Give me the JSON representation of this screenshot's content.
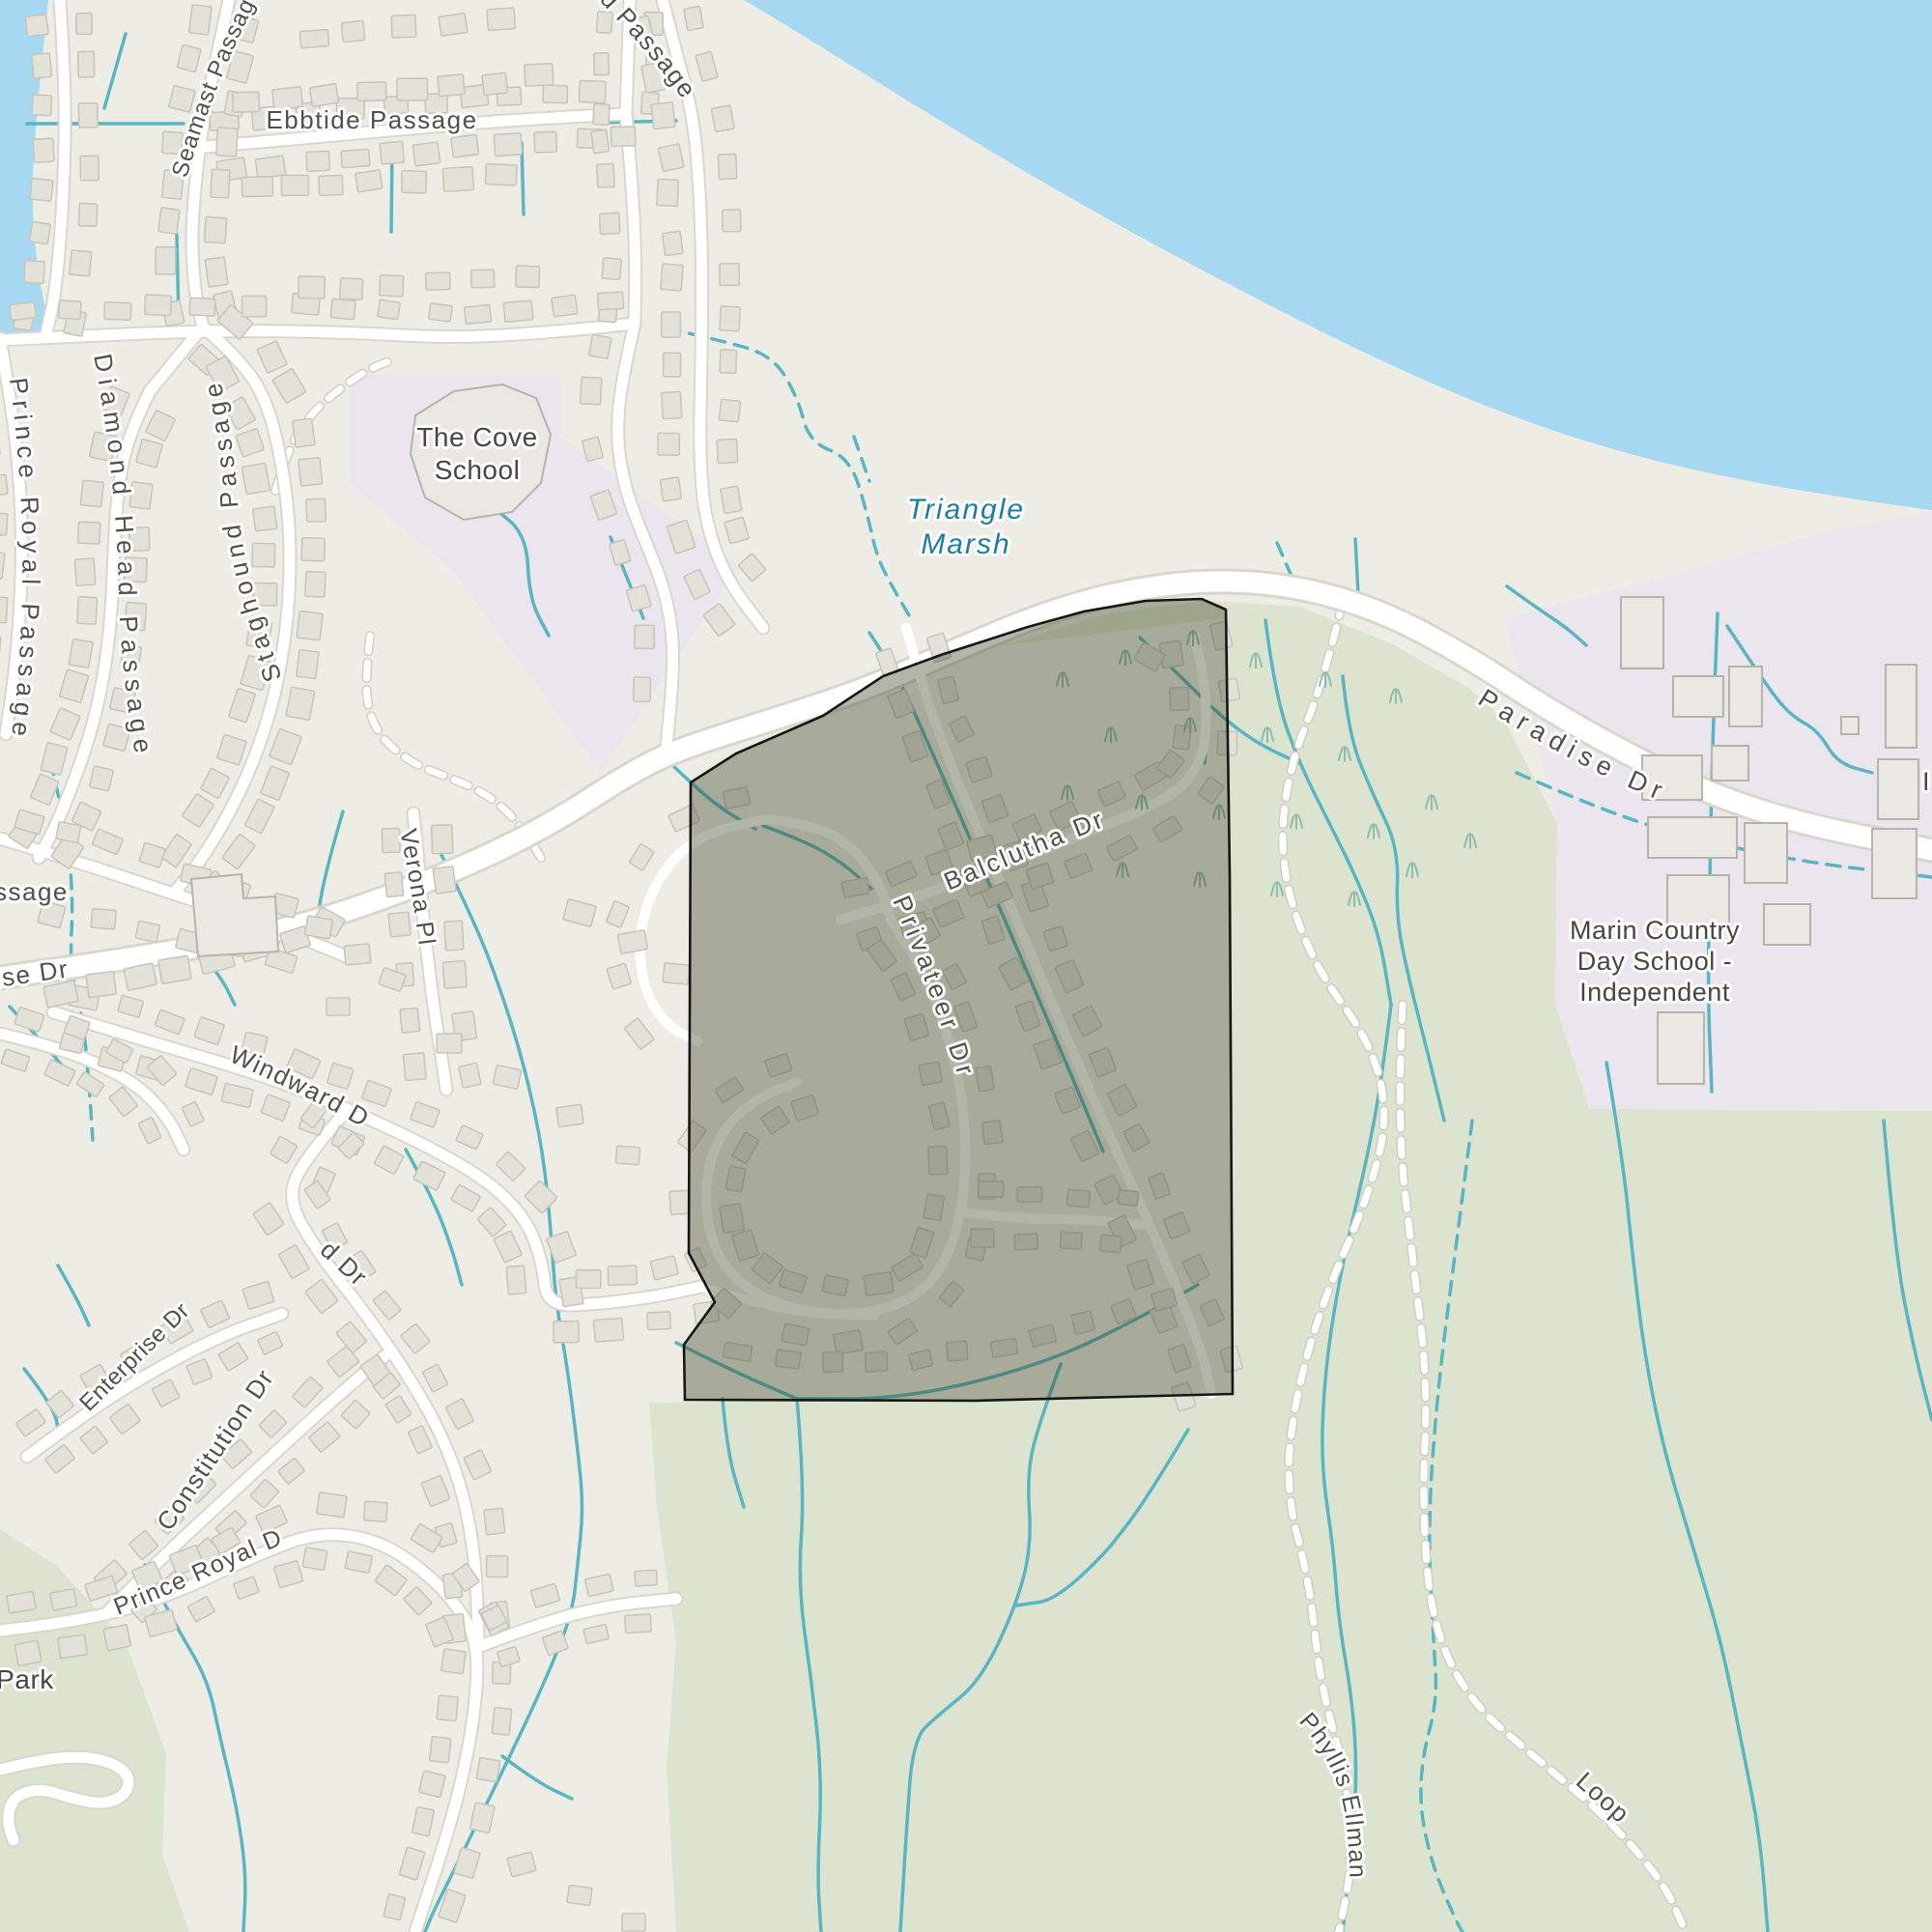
{
  "map": {
    "kind": "street-map-with-highlighted-area",
    "highlighted_area_streets": [
      "Balclutha Dr",
      "Privateer Dr"
    ]
  },
  "labels": {
    "ebbtide": "Ebbtide Passage",
    "seamast": "Seamast Passage",
    "staghound": "Staghound Passage",
    "diamond": "Diamond Head Passage",
    "prince_royal_passage": "Prince Royal Passage",
    "passage_fragment": "ssage",
    "ise_dr_fragment": "ise Dr",
    "d_passage_fragment": "d Passage",
    "cove_school_line1": "The Cove",
    "cove_school_line2": "School",
    "triangle_marsh_line1": "Triangle",
    "triangle_marsh_line2": "Marsh",
    "paradise_dr": "Paradise Dr",
    "balclutha_dr": "Balclutha Dr",
    "privateer_dr": "Privateer Dr",
    "verona_pl": "Verona Pl",
    "windward_dr": "Windward Dr",
    "windward_fragment": "d Dr",
    "enterprise_dr": "Enterprise Dr",
    "constitution_dr": "Constitution Dr",
    "prince_royal_dr": "Prince Royal Dr",
    "park": "Park",
    "mcds_line1": "Marin Country",
    "mcds_line2": "Day School -",
    "mcds_line3": "Independent",
    "phyllis_ellman": "Phyllis Ellman",
    "loop": "Loop",
    "i_fragment": "I"
  },
  "colors": {
    "land": "#eeede5",
    "water": "#a7d8f1",
    "park": "#dce3ce",
    "school_area": "#ebe6ed",
    "road_fill": "#ffffff",
    "road_casing": "#d8d7cc",
    "stream": "#5ab5c2",
    "trail": "#ffffff",
    "trail_casing": "#cfceC4",
    "building_fill": "#e3e2d9",
    "building_stroke": "#c7c6bc",
    "big_building_fill": "#eae8e2",
    "big_building_stroke": "#b5b4ab",
    "grass_symbol": "#8fbcae",
    "highlight_fill": "rgba(62,72,40,0.40)",
    "highlight_outline": "#161614",
    "label_street": "#50504a",
    "label_place": "#474740",
    "label_water": "#1a7da3"
  }
}
